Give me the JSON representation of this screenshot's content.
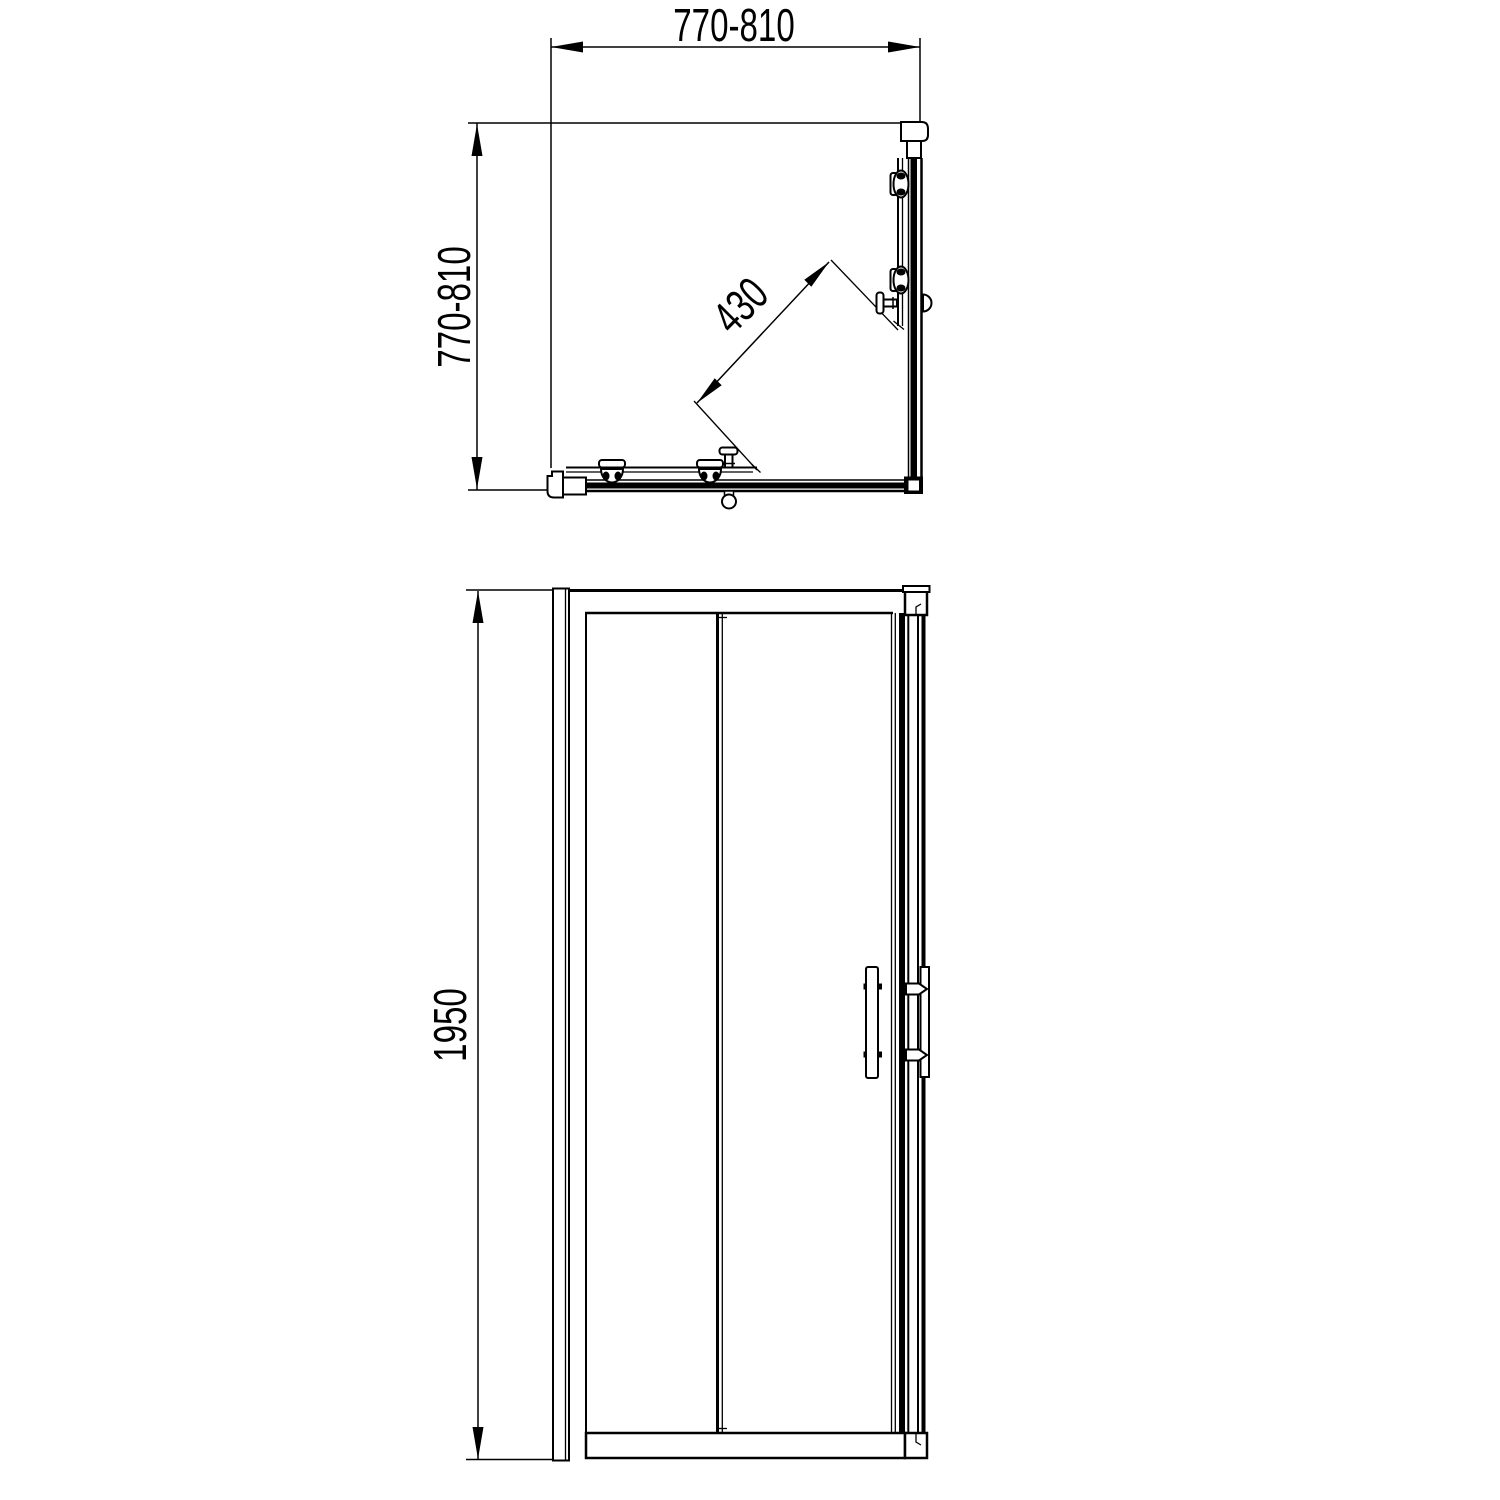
{
  "drawing": {
    "kind": "technical-drawing",
    "subject": "corner-entry sliding-door shower enclosure",
    "line_color": "#000000",
    "background_color": "#ffffff",
    "plan_view": {
      "width_dim_label": "770-810",
      "depth_dim_label": "770-810",
      "diagonal_opening_label": "430"
    },
    "elevation_view": {
      "height_dim_label": "1950"
    }
  }
}
